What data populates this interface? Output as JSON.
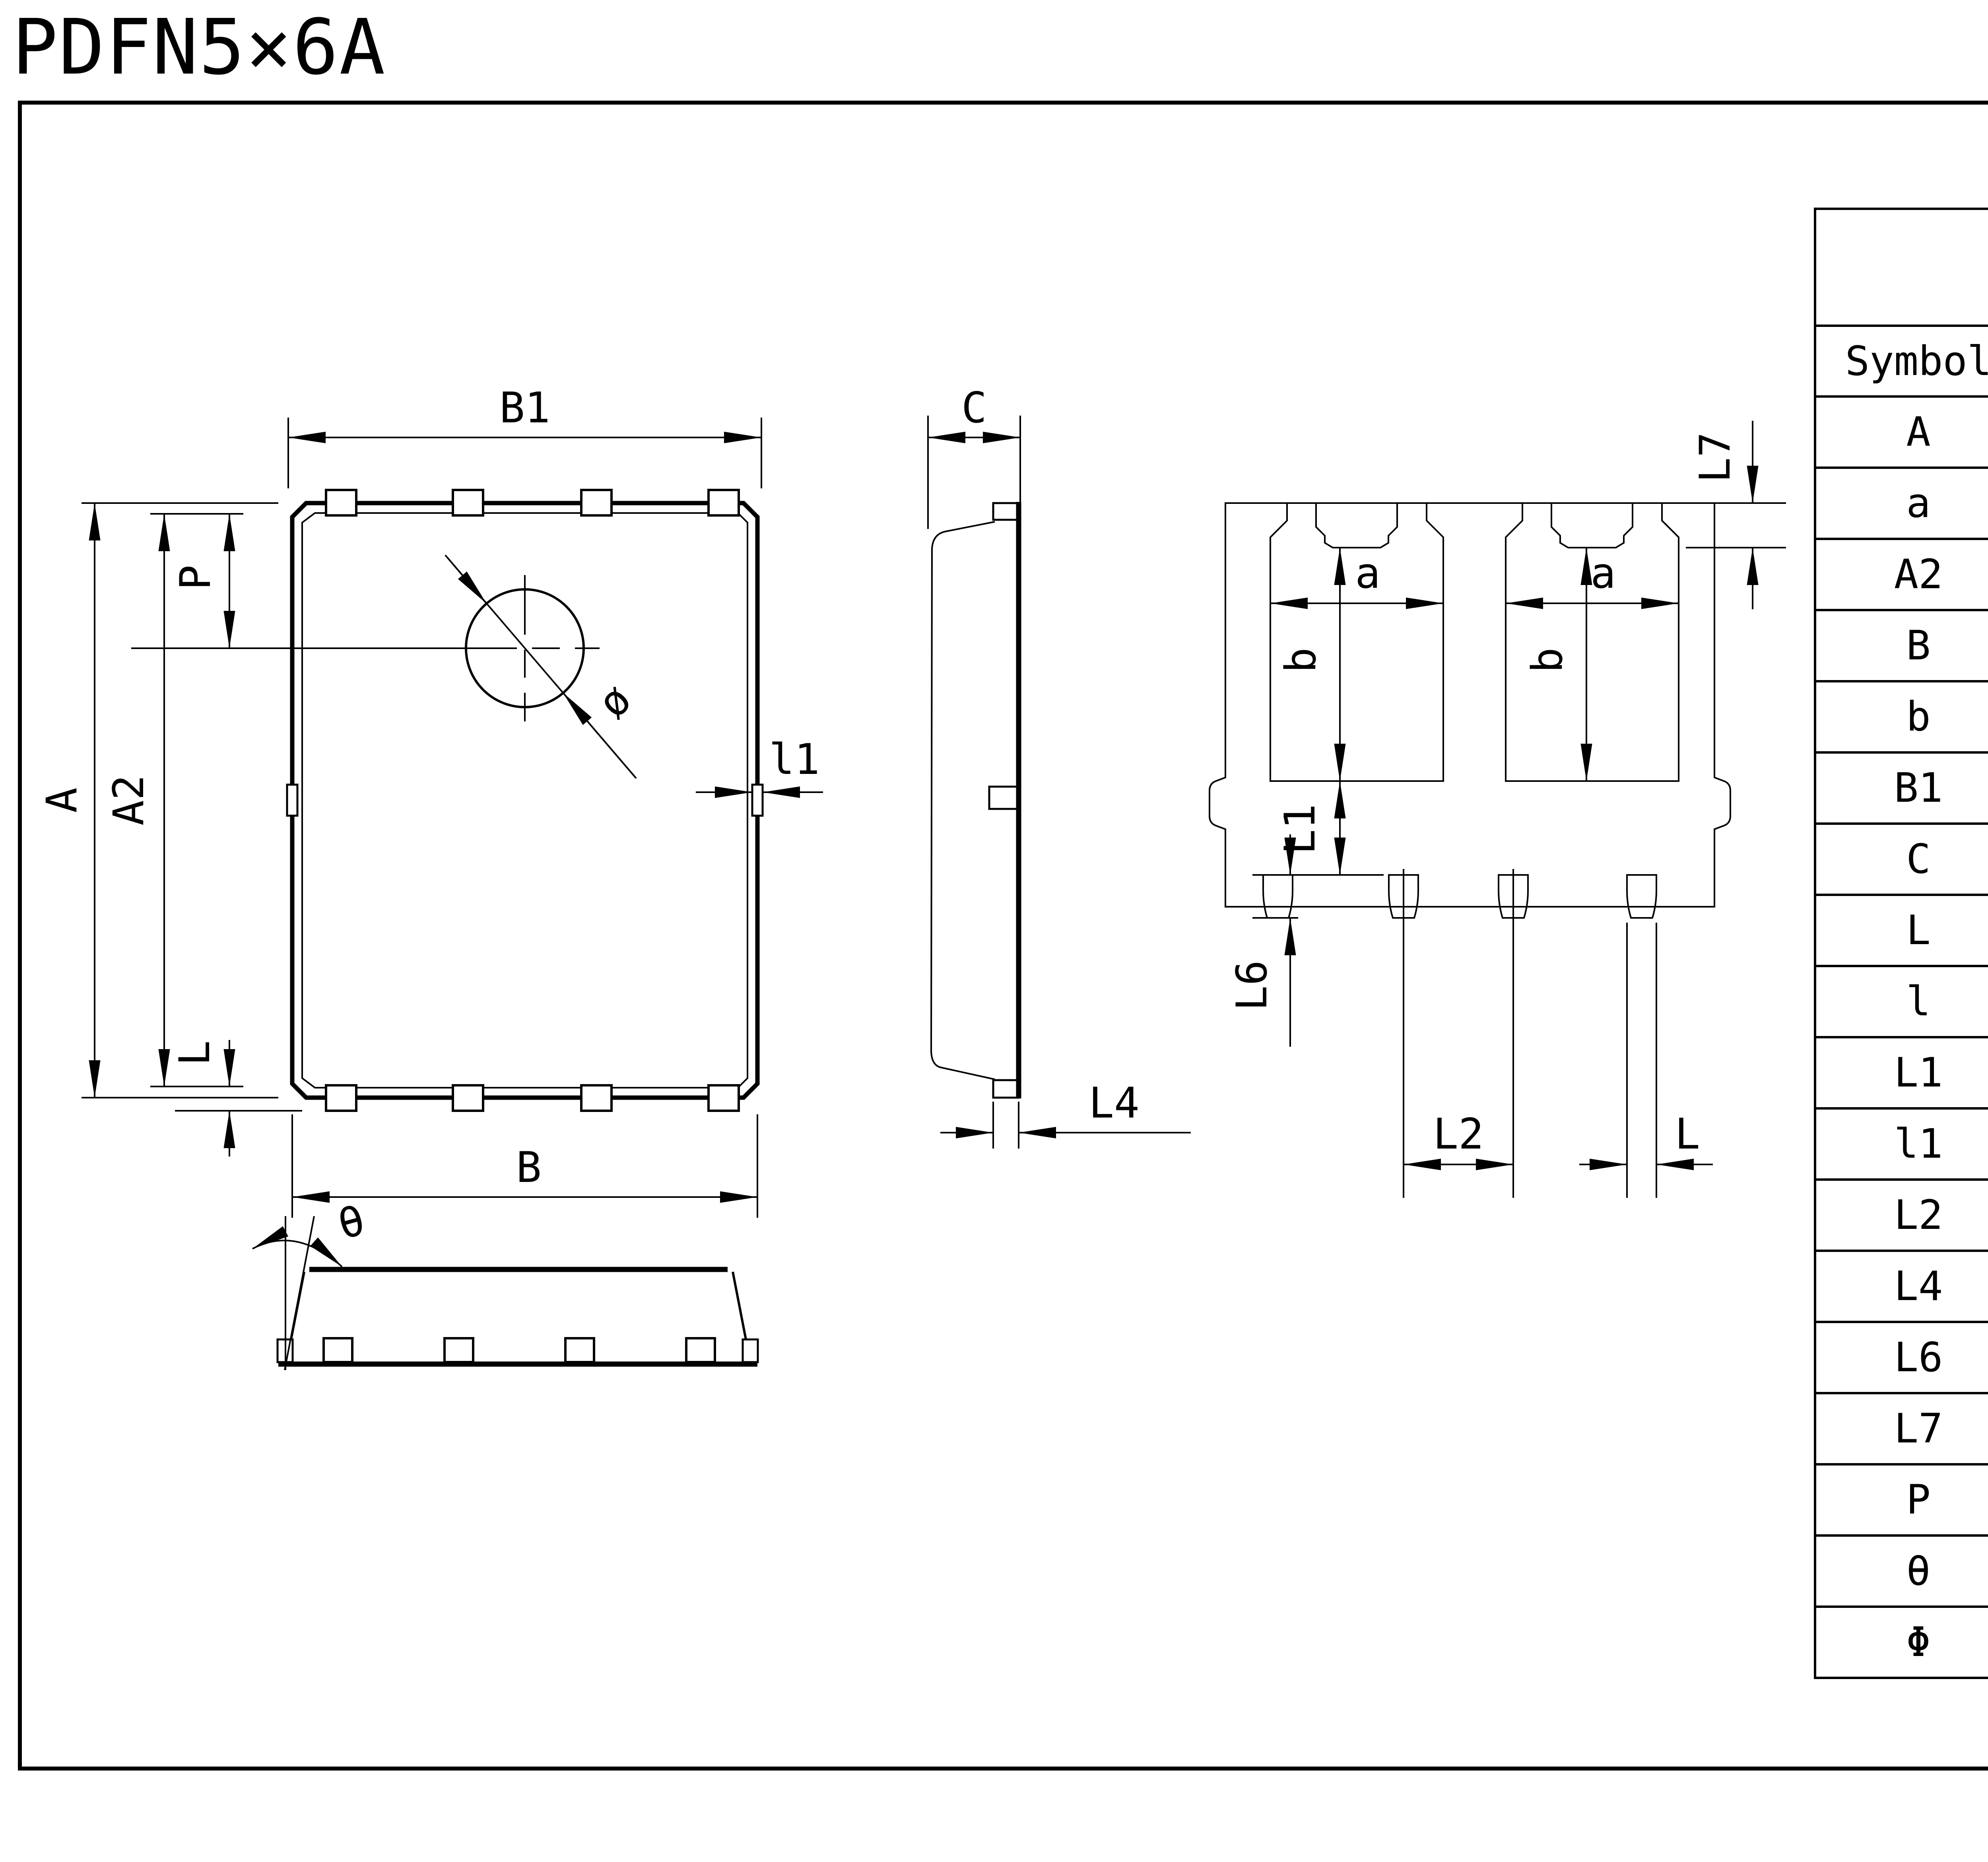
{
  "page": {
    "title": "PDFN5×6A",
    "unit_label": "Unit:mm",
    "revision": "Rev.01 202209"
  },
  "table": {
    "title_line1": "Dimensions  In",
    "title_line2": "Millimeters",
    "headers": [
      "Symbol",
      "MIN",
      "TYP",
      "MAX"
    ],
    "rows": [
      {
        "symbol": "A",
        "min": "5.90",
        "typ": "6.00",
        "max": "6.10"
      },
      {
        "symbol": "a",
        "min": "1.605",
        "typ": "1.705",
        "max": "1.805"
      },
      {
        "symbol": "A2",
        "min": "5.70",
        "typ": "5.75",
        "max": "5.80"
      },
      {
        "symbol": "B",
        "min": "4.90",
        "typ": "5.00",
        "max": "5.10"
      },
      {
        "symbol": "b",
        "min": "3.375",
        "typ": "3.475",
        "max": "3.575"
      },
      {
        "symbol": "B1",
        "min": "4.80",
        "typ": "4.90",
        "max": "5.00"
      },
      {
        "symbol": "C",
        "min": "0.90",
        "typ": "0.95",
        "max": "1.00"
      },
      {
        "symbol": "L",
        "min": "0.30",
        "typ": "0.40",
        "max": "0.50"
      },
      {
        "symbol": "l",
        "min": "0.06",
        "typ": "0.13",
        "max": "0.20"
      },
      {
        "symbol": "L1",
        "min": "1.10",
        "typ": "–",
        "max": "–"
      },
      {
        "symbol": "l1",
        "min": "–",
        "typ": "–",
        "max": "0.10"
      },
      {
        "symbol": "L2",
        "min": "1.17",
        "typ": "1.27",
        "max": "1.37"
      },
      {
        "symbol": "L4",
        "min": "0.21",
        "typ": "0.26",
        "max": "0.34"
      },
      {
        "symbol": "L6",
        "min": "0.51",
        "typ": "0.61",
        "max": "0.71"
      },
      {
        "symbol": "L7",
        "min": "0.45",
        "typ": "0.55",
        "max": "0.65"
      },
      {
        "symbol": "P",
        "min": "1.15",
        "typ": "1.30",
        "max": "145"
      },
      {
        "symbol": "θ",
        "min": "8°",
        "typ": "10°",
        "max": "12°"
      },
      {
        "symbol": "Φ",
        "min": "1.10",
        "typ": "1.20",
        "max": "1.30"
      }
    ]
  },
  "views": {
    "top": {
      "b1": "B1",
      "a": "A",
      "a2": "A2",
      "p": "P",
      "l": "L",
      "b": "B",
      "l1": "l1",
      "dia": "ø"
    },
    "side": {
      "c": "C",
      "l4": "L4"
    },
    "bottom": {
      "a_left": "a",
      "a_right": "a",
      "b_left": "b",
      "b_right": "b",
      "l1": "L1",
      "l2": "L2",
      "l6": "L6",
      "l7": "L7",
      "l": "L"
    },
    "front": {
      "theta": "θ"
    }
  }
}
